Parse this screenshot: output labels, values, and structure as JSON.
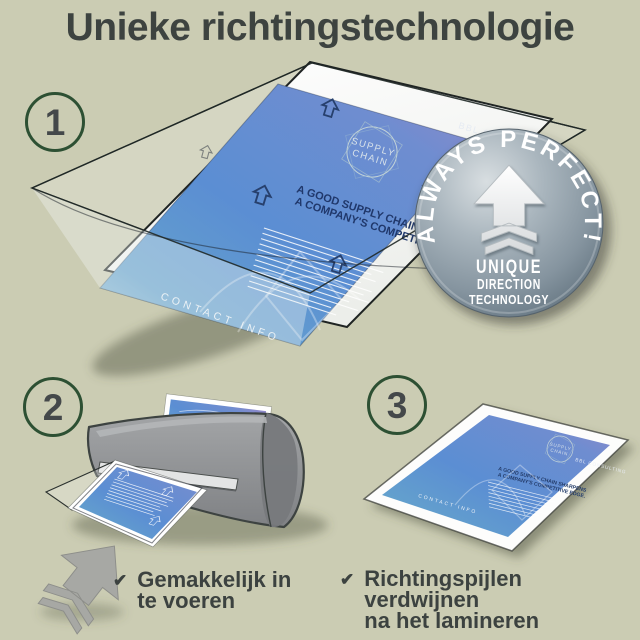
{
  "title": "Unieke richtingstechnologie",
  "check_glyph": "✔",
  "steps": [
    {
      "number": "1"
    },
    {
      "number": "2",
      "caption_line1": "Gemakkelijk in",
      "caption_line2": "te voeren"
    },
    {
      "number": "3",
      "caption_line1": "Richtingspijlen verdwijnen",
      "caption_line2": "na het lamineren"
    }
  ],
  "badge": {
    "arc_text": "ALWAYS PERFECT!",
    "line1": "UNIQUE",
    "line2": "DIRECTION",
    "line3": "TECHNOLOGY"
  },
  "flyer": {
    "brand": "BBL CONSULTING",
    "circle_word1": "SUPPLY",
    "circle_word2": "CHAIN",
    "heading_line1": "A GOOD SUPPLY CHAIN SHARPENS",
    "heading_line2": "A COMPANY'S COMPETITIVE EDGE.",
    "footer": "CONTACT INFO"
  },
  "colors": {
    "background": "#cbccb3",
    "title_text": "#3d4340",
    "circle_ring_green": "#2d5033",
    "caption_text": "#3c4240",
    "flyer_blue": "#5b8ed3",
    "flyer_purple": "#9288c9",
    "flyer_teal": "#9fc8d8",
    "badge_face": "#85949f",
    "badge_text": "#ffffff",
    "machine_gray": "#909294"
  }
}
